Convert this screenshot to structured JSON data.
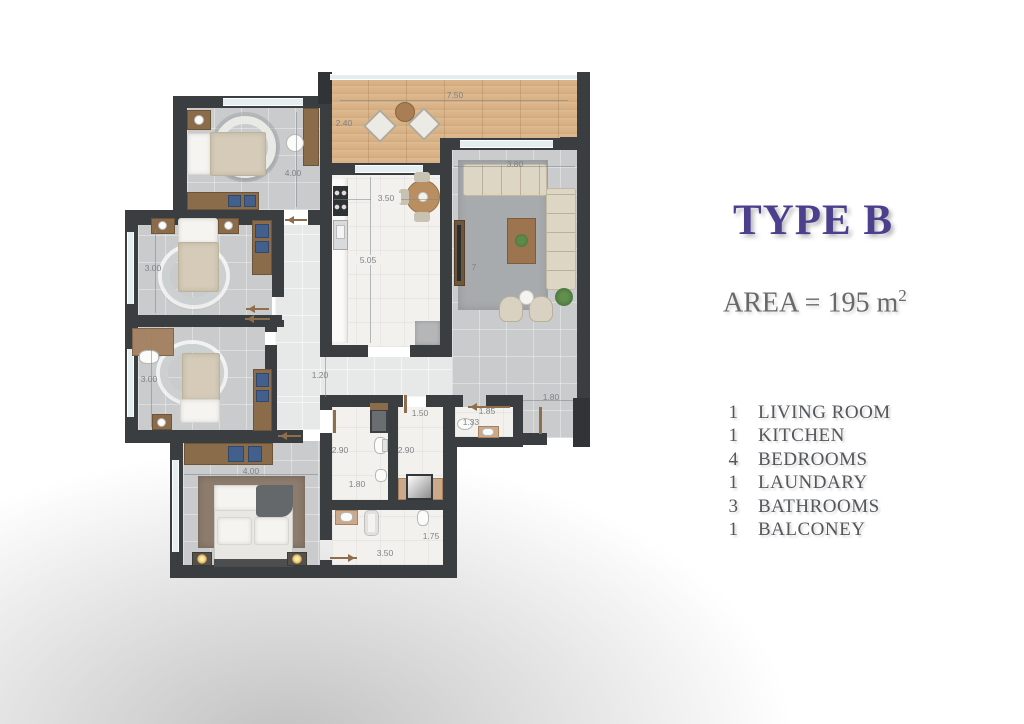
{
  "panel": {
    "title": "TYPE B",
    "area_prefix": "AREA = 195 m",
    "area_exponent": "2",
    "legend": [
      {
        "count": "1",
        "label": "LIVING ROOM"
      },
      {
        "count": "1",
        "label": "KITCHEN"
      },
      {
        "count": "4",
        "label": "BEDROOMS"
      },
      {
        "count": "1",
        "label": "LAUNDARY"
      },
      {
        "count": "3",
        "label": "BATHROOMS"
      },
      {
        "count": "1",
        "label": "BALCONEY"
      }
    ]
  },
  "plan": {
    "dims": {
      "balcony_width": "7.50",
      "balcony_depth": "2.40",
      "bedroom1": "4.00",
      "bedroom2": "3.00",
      "bedroom3": "3.00",
      "master_bedroom": "4.00",
      "kitchen_width": "3.50",
      "kitchen_length": "5.05",
      "living_width": "3.80",
      "living_partial": "7",
      "corridor": "1.20",
      "entry_hall": "1.80",
      "bath_a_length": "2.90",
      "bath_a_width": "1.80",
      "laundry_width": "1.50",
      "laundry_length": "2.90",
      "bath_c_width": "1.85",
      "bath_c_depth": "1.33",
      "bath_d_depth": "1.75",
      "bath_d_width": "3.50"
    }
  },
  "colors": {
    "accent_purple": "#4c3f8e",
    "wall": "#3a3e41",
    "wood_floor": "#d8b289",
    "text_gray": "#54575a"
  }
}
